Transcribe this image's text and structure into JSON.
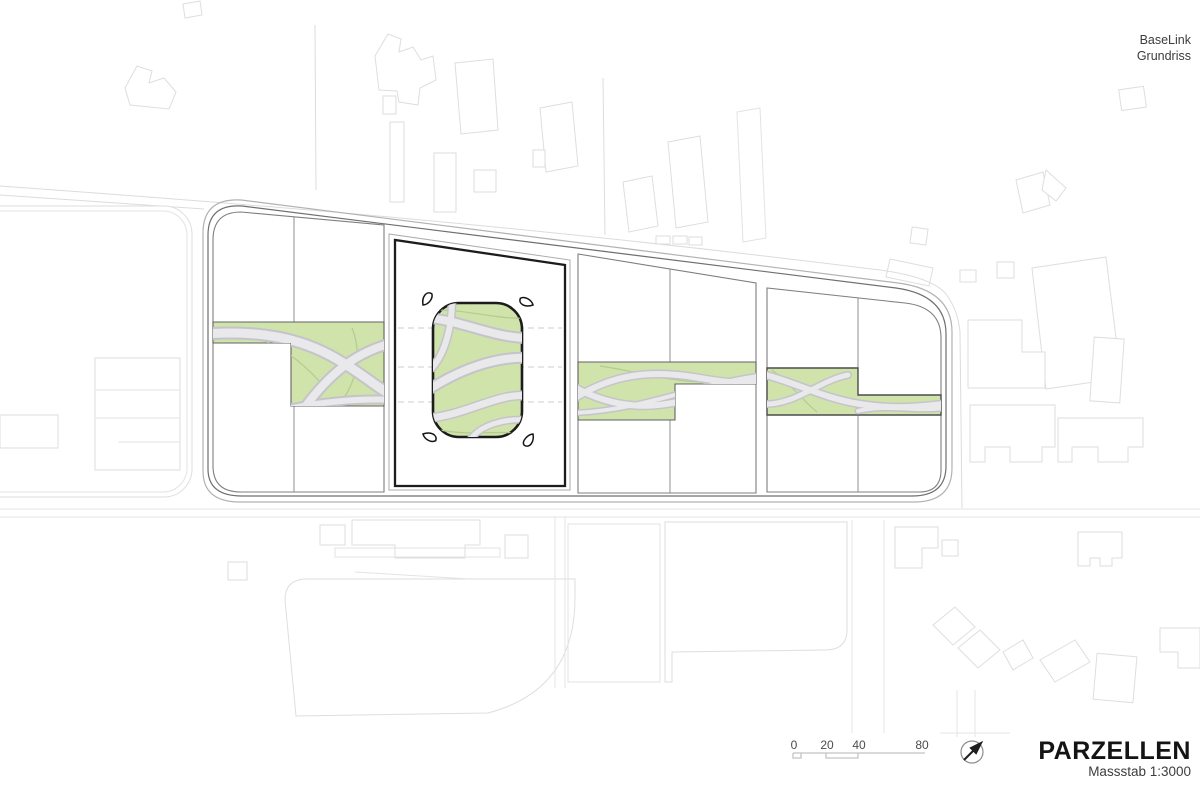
{
  "header": {
    "project_name": "BaseLink",
    "drawing_type": "Grundriss"
  },
  "title_block": {
    "title": "PARZELLEN",
    "scale": "Massstab 1:3000"
  },
  "scale_bar": {
    "labels": [
      "0",
      "20",
      "40",
      "80"
    ]
  },
  "icons": {
    "north_arrow": "north-arrow-icon"
  },
  "colors": {
    "paper": "#ffffff",
    "green": "#cfe3ab",
    "path-fill": "#e9e9ec",
    "path-edge": "#c4c4ca",
    "parcel-line": "#1c1c1c"
  }
}
